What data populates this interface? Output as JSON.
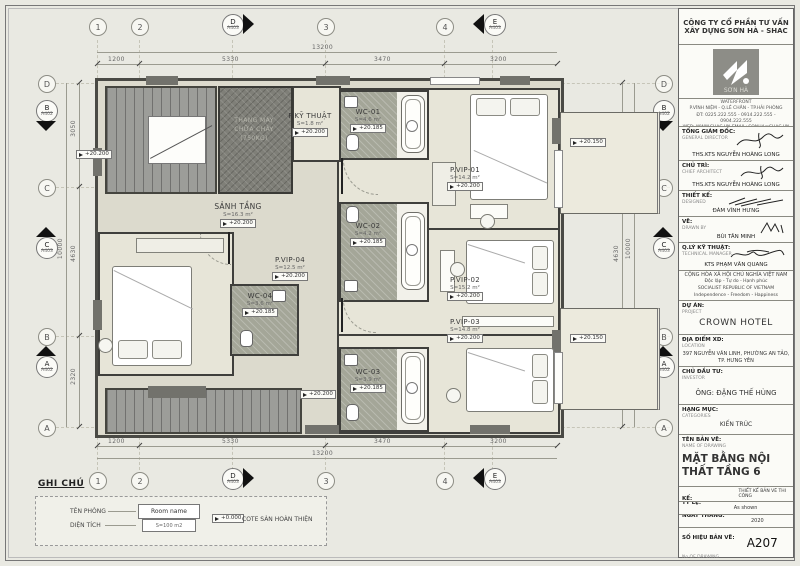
{
  "titleblock": {
    "company_name_line1": "CÔNG TY CỔ PHẦN TƯ VẤN",
    "company_name_line2": "XÂY DỰNG SƠN HÀ - SHAC",
    "logo_text": "SƠN HÀ",
    "address_line1": "ĐC: SỐ 55 ĐƯỜNG 22 KHU ĐÔ THỊ WATERFRONT",
    "address_line2": "P.VĨNH NIỆM - Q.LÊ CHÂN - TP.HẢI PHÒNG",
    "address_line3": "ĐT: 0225.222.555 - 0914.222.555 - 0904.222.555",
    "address_line4": "WEB: WWW.SHAC.VN EMAIL: SONHA@SHAC.VN",
    "roles": [
      {
        "label": "TỔNG GIÁM ĐỐC:",
        "sub": "GENERAL DIRECTOR",
        "name": "THS.KTS NGUYỄN HOÀNG LONG"
      },
      {
        "label": "CHỦ TRÌ:",
        "sub": "CHIEF ARCHITECT",
        "name": "THS.KTS NGUYỄN HOÀNG LONG"
      },
      {
        "label": "THIẾT KẾ:",
        "sub": "DESIGNED",
        "name": "ĐÀM VĨNH HƯNG"
      },
      {
        "label": "VẼ:",
        "sub": "DRAWN BY",
        "name": "BÙI TÂN MINH"
      },
      {
        "label": "Q.LÝ KỸ THUẬT:",
        "sub": "TECHNICAL MANAGER",
        "name": "KTS PHẠM VĂN QUANG"
      }
    ],
    "republic": {
      "l1": "CỘNG HÒA XÃ HỘI CHỦ NGHĨA VIỆT NAM",
      "l2": "Độc lập - Tự do - Hạnh phúc",
      "l3": "SOCIALIST REPUBLIC OF VIETNAM",
      "l4": "Independence - Freedom - Happiness"
    },
    "project": {
      "label": "DỰ ÁN:",
      "sub": "PROJECT",
      "value": "CROWN HOTEL"
    },
    "location": {
      "label": "ĐỊA ĐIỂM XD:",
      "sub": "LOCATION",
      "value": "397 NGUYỄN VĂN LINH, PHƯỜNG AN TẢO, TP. HƯNG YÊN"
    },
    "investor": {
      "label": "CHỦ ĐẦU TƯ:",
      "sub": "INVESTOR",
      "value": "ÔNG: ĐẶNG THẾ HÙNG"
    },
    "category": {
      "label": "HẠNG MỤC:",
      "sub": "CATEGORIES",
      "value": "KIẾN TRÚC"
    },
    "drawing_name": {
      "label": "TÊN BẢN VẼ:",
      "sub": "NAME OF DRAWING",
      "value": "MẶT BẰNG NỘI THẤT TẦNG 6"
    },
    "stage": {
      "label": "GIAI ĐOẠN THIẾT KẾ:",
      "sub": "DESIGNING",
      "value": "THIẾT KẾ BẢN VẼ THI CÔNG"
    },
    "scale": {
      "label": "TỶ LỆ:",
      "sub": "SCALE",
      "value": "As shown"
    },
    "date": {
      "label": "NGÀY THÁNG:",
      "sub": "DATE",
      "value": "2020"
    },
    "number": {
      "label": "SỐ HIỆU BẢN VẼ:",
      "sub": "No OF DRAWING",
      "value": "A207"
    }
  },
  "plan": {
    "rooms": {
      "kythuat": {
        "name": "P.KỸ THUẬT",
        "area": "S=1.8 m²",
        "level": "+20.200"
      },
      "wc01": {
        "name": "WC-01",
        "area": "S=4.6 m²",
        "level": "+20.185"
      },
      "vip01": {
        "name": "P.VIP-01",
        "area": "S=14.2 m²",
        "level": "+20.200"
      },
      "wc02": {
        "name": "WC-02",
        "area": "S=4.2 m²",
        "level": "+20.185"
      },
      "vip02": {
        "name": "P.VIP-02",
        "area": "S=15.2 m²",
        "level": "+20.200"
      },
      "wc03": {
        "name": "WC-03",
        "area": "S=3.9 m²",
        "level": "+20.185"
      },
      "vip03": {
        "name": "P.VIP-03",
        "area": "S=14.8 m²",
        "level": "+20.200"
      },
      "vip04": {
        "name": "P.VIP-04",
        "area": "S=12.5 m²",
        "level": "+20.200"
      },
      "wc04": {
        "name": "WC-04",
        "area": "S=3.6 m²",
        "level": "+20.185"
      },
      "sanh": {
        "name": "SẢNH TẦNG",
        "area": "S=16.3 m²",
        "level": "+20.200"
      },
      "elevator": {
        "l1": "THANG MÁY",
        "l2": "CHỮA CHÁY",
        "l3": "(750KG)"
      }
    },
    "balcony_level": "+20.150",
    "hall_level": "+20.200",
    "grid": {
      "cols": [
        "1",
        "2",
        "3",
        "4"
      ],
      "rows": [
        "D",
        "C",
        "B",
        "A"
      ],
      "sections": {
        "d": {
          "label": "D",
          "ref": "A403"
        },
        "e": {
          "label": "E",
          "ref": "A403"
        },
        "b": {
          "label": "B",
          "ref": "A402"
        },
        "c": {
          "label": "C",
          "ref": "A403"
        },
        "a": {
          "label": "A",
          "ref": "A402"
        }
      }
    },
    "dims": {
      "top": [
        "1200",
        "5330",
        "3470",
        "3200"
      ],
      "overall_h": "13200",
      "left": [
        "3050",
        "4630",
        "2320"
      ],
      "overall_v": "10000"
    }
  },
  "legend": {
    "title": "GHI CHÚ",
    "room_name_label": "TÊN PHÒNG",
    "room_name_value": "Room name",
    "area_label": "DIỆN TÍCH",
    "area_value": "S=100 m2",
    "cote_value": "+0.000",
    "cote_label": "COTE SÀN HOÀN THIỆN"
  },
  "colors": {
    "accent_dark_wall": "#3f3f3c",
    "wc_fill": "#a4a698",
    "room_fill": "#e7e5d8"
  }
}
